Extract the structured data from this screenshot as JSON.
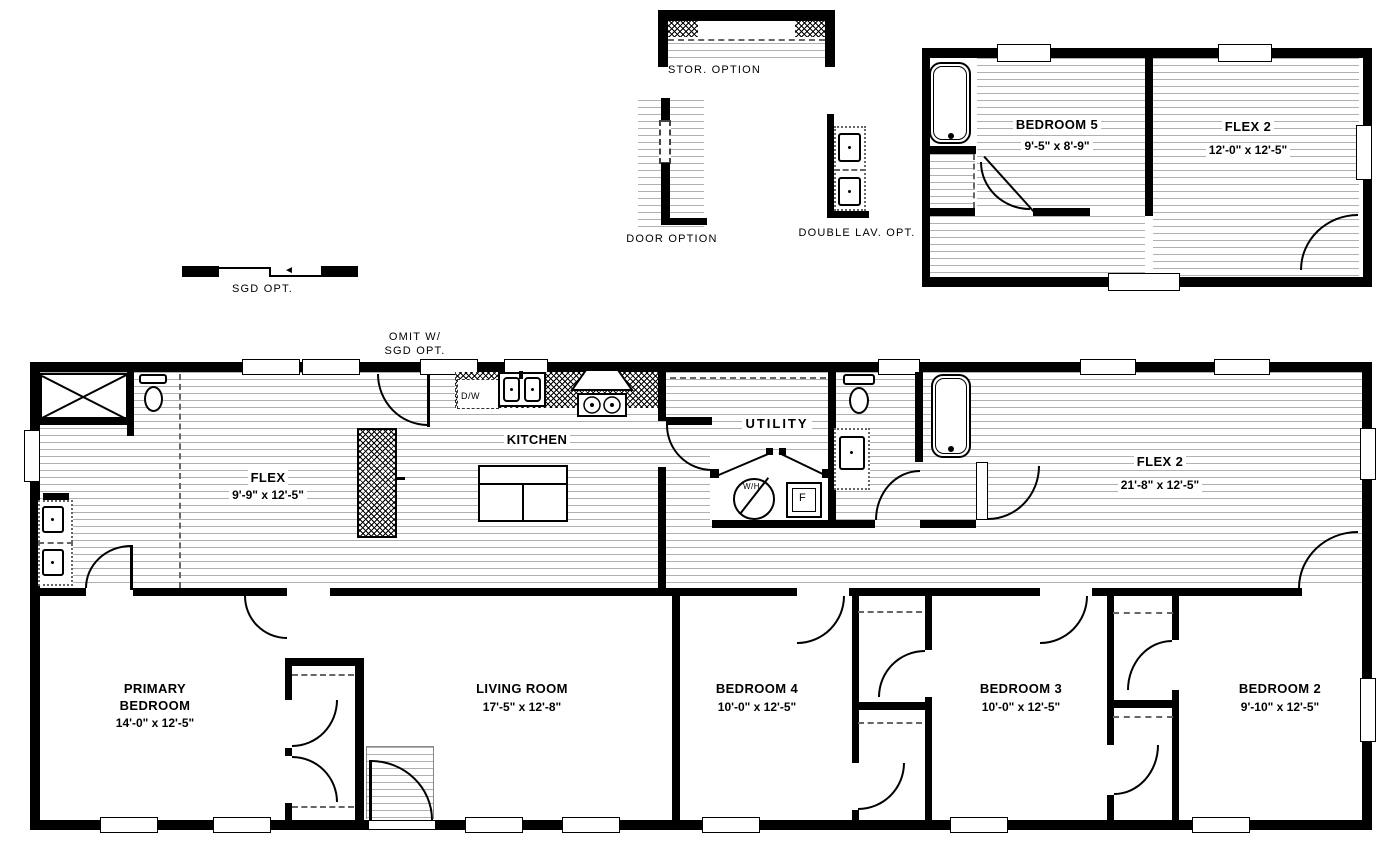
{
  "options": {
    "stor": "STOR. OPTION",
    "door": "DOOR OPTION",
    "double_lav": "DOUBLE LAV. OPT.",
    "sgd": "SGD OPT.",
    "omit_line1": "OMIT W/",
    "omit_line2": "SGD OPT."
  },
  "upper_plan": {
    "bedroom5": {
      "name": "BEDROOM 5",
      "dims": "9'-5\" x  8'-9\""
    },
    "flex2": {
      "name": "FLEX 2",
      "dims": "12'-0\" x  12'-5\""
    }
  },
  "main_plan": {
    "flex": {
      "name": "FLEX",
      "dims": "9'-9\" x  12'-5\""
    },
    "kitchen": {
      "name": "KITCHEN"
    },
    "utility": {
      "name": "UTILITY"
    },
    "flex2": {
      "name": "FLEX 2",
      "dims": "21'-8\" x  12'-5\""
    },
    "primary": {
      "name1": "PRIMARY",
      "name2": "BEDROOM",
      "dims": "14'-0\" x  12'-5\""
    },
    "living": {
      "name": "LIVING ROOM",
      "dims": "17'-5\" x  12'-8\""
    },
    "bedroom4": {
      "name": "BEDROOM 4",
      "dims": "10'-0\" x  12'-5\""
    },
    "bedroom3": {
      "name": "BEDROOM 3",
      "dims": "10'-0\" x  12'-5\""
    },
    "bedroom2": {
      "name": "BEDROOM 2",
      "dims": "9'-10\" x  12'-5\""
    }
  },
  "fixtures": {
    "dishwasher": "D/W",
    "water_heater": "W/H",
    "furnace": "F"
  },
  "colors": {
    "wall": "#000000",
    "hatch": "#b0b0b0",
    "background": "#ffffff"
  }
}
